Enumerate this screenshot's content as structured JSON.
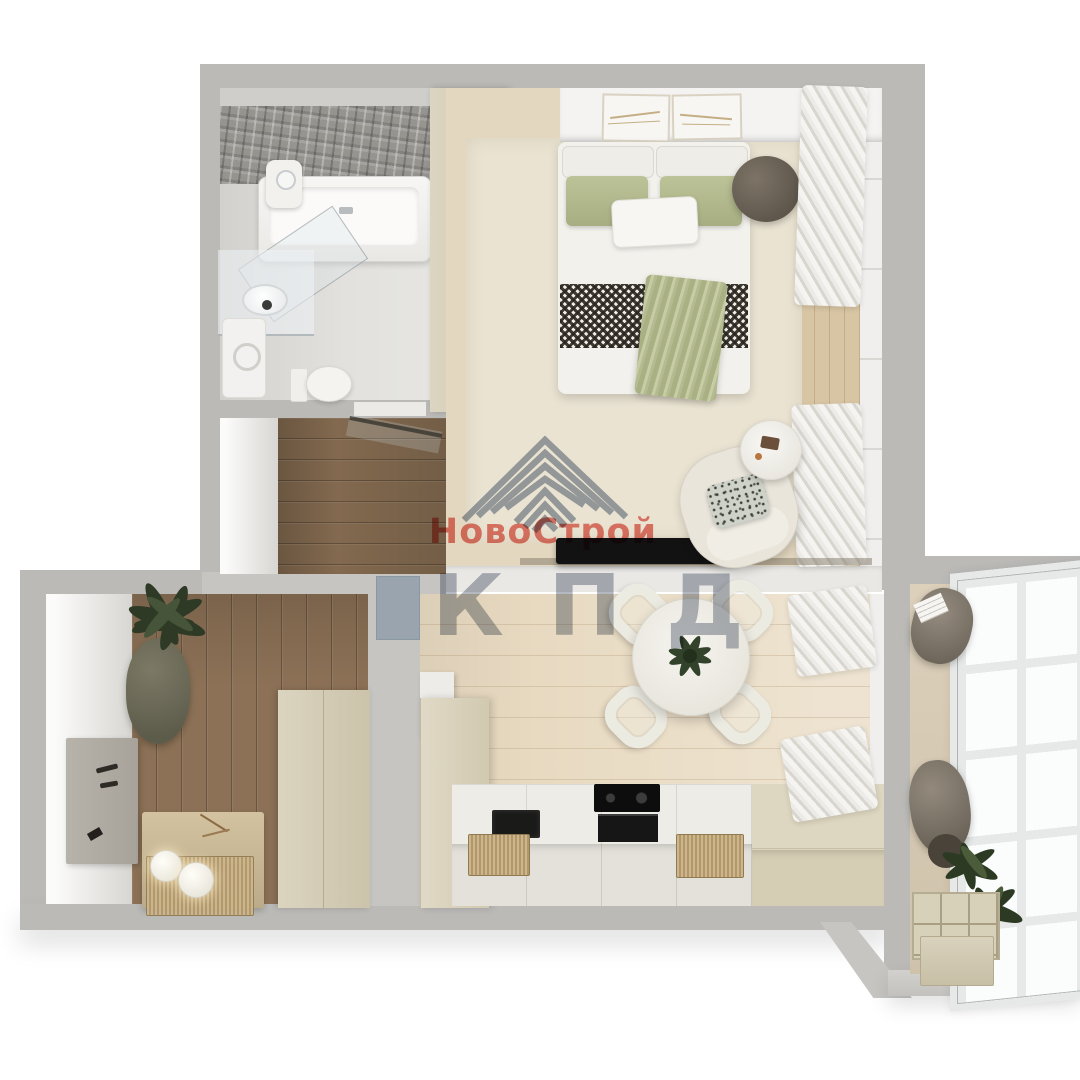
{
  "watermark": {
    "logo_icon": "nested-chevrons-pyramid-icon",
    "brand_name": "НовоСтрой",
    "brand_abbr": "КПД",
    "brand_name_color": "#e25c50",
    "brand_abbr_color": "#747e8e",
    "logo_color": "#66758c"
  },
  "palette": {
    "background": "#ffffff",
    "wall_grey": "#bbbab7",
    "wall_white_band": "#e9e8e5",
    "bathroom_accent_stone": "#96948f",
    "bathroom_floor": "#dbdad7",
    "dark_wood_floor": "#856c52",
    "kitchen_wood_floor": "#e8dac1",
    "bedroom_rug": "#eae3d2",
    "wardrobe_beige": "#d2cab1",
    "bedding_white": "#f3f1ec",
    "pillow_green": "#b2b98e",
    "throw_check_dark": "#44403a",
    "pouf_brown": "#6e6559",
    "tv_black": "#121212",
    "counter_white": "#edebe6",
    "counter_beige": "#d9d2bb",
    "mat_tan": "#c3ab80",
    "curtain_white": "#f2f1ee",
    "plant_green": "#33422a",
    "window_pane": "#fbfcfc"
  }
}
